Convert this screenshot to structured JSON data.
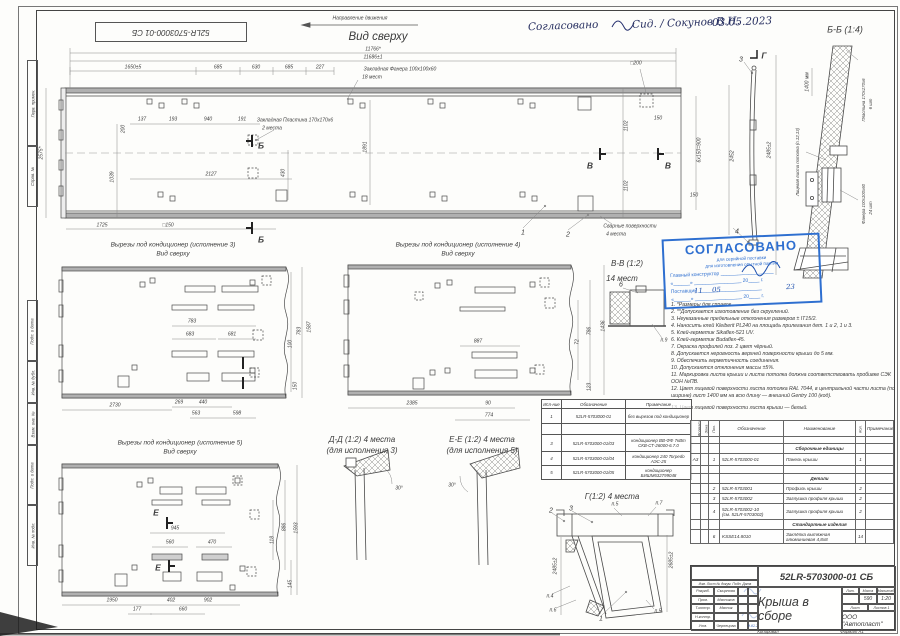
{
  "corner_code": "52LR-5703000-01 СБ",
  "hand": {
    "w": "Согласовано",
    "n": "Сид. / Сокунов В.Н.",
    "d": "03.05.2023"
  },
  "tv": {
    "dir": "Направление движения",
    "title": "Вид сверху",
    "d11766": "11766*",
    "d11686": "11686±1",
    "c1": "1650±5",
    "c2": "685",
    "c3": "630",
    "c4": "685",
    "c5": "227",
    "fanera": "Закладная Фанера 100х100х60",
    "fanera_q": "18 мест",
    "plast": "Закладная Пластина 170х170х6",
    "plast_q": "2 места",
    "sq200": "□200",
    "sq150": "□150",
    "d2575": "2575*",
    "d137": "137",
    "d193": "193",
    "d940": "940",
    "d191": "191",
    "d200": "200",
    "d1039": "1039",
    "d2127": "2127",
    "d430": "430",
    "d1725": "1725",
    "d1891": "1891",
    "d1102": "1102",
    "d150": "150",
    "d6x150": "6х150=900",
    "d2452": "2452",
    "secB": "Б",
    "secV": "В",
    "co1": "1",
    "co2": "2",
    "co3": "3",
    "co4": "4",
    "coG": "Г",
    "weld": "Сварные поверхности",
    "weld_q": "4 места"
  },
  "bb": {
    "title": "Б-Б (1:4)",
    "d1400": "1400 мм",
    "d2485": "2485±2",
    "plate": "Пластина 170х170х6",
    "plate_q": "6 шт",
    "ply": "Фанера 100х100х60",
    "ply_q": "24 шт",
    "face": "Лицевая листа потолка (п.12,13)"
  },
  "c3v": {
    "t": "Вырезы под кондиционер (исполнение 3)",
    "s": "Вид сверху",
    "d783": "783",
    "d683": "683",
    "d681": "681",
    "d2730": "2730",
    "d269": "269",
    "d440": "440",
    "d563": "563",
    "d598": "598",
    "d100": "100",
    "d1587": "1587",
    "d150": "150",
    "d783r": "783"
  },
  "c4v": {
    "t": "Вырезы под кондиционер (исполнение 4)",
    "s": "Вид сверху",
    "d887": "887",
    "d2385": "2385",
    "d90": "90",
    "d774": "774",
    "d72": "72",
    "d786": "786",
    "d1436": "1436",
    "d123": "123"
  },
  "c5v": {
    "t": "Вырезы под кондиционер (исполнение 5)",
    "s": "Вид сверху",
    "secE": "Е",
    "d945": "945",
    "d560": "560",
    "d470": "470",
    "d1950": "1950",
    "d177": "177",
    "d402": "402",
    "d660": "660",
    "d902": "902",
    "d118": "118",
    "d886": "886",
    "d1593": "1593",
    "d145": "145"
  },
  "dd": {
    "t": "Д-Д (1:2) 4 места",
    "s": "(для исполнения 3)",
    "ang": "30°"
  },
  "ee": {
    "t": "Е-Е (1:2) 4 места",
    "s": "(для исполнения 5)",
    "ang": "30°"
  },
  "gg": {
    "t": "Г(1:2) 4 места",
    "co1": "1",
    "co2": "2",
    "co3": "3",
    "n4": "п.4",
    "n5": "п.5",
    "n6": "п.6",
    "n7": "п.7",
    "dl": "2485±2",
    "dr": "2685±2"
  },
  "vv": {
    "t": "В-В (1:2)",
    "s": "14 мест",
    "co6": "6",
    "n9": "п.9"
  },
  "stamp": {
    "t": "СОГЛАСОВАНО",
    "l1": "для серийной поставки",
    "l2": "для изготовления опытной партии",
    "gk": "Главный конструктор ___________________",
    "dt1": "«______» _________________ 20____ г.",
    "post": "Поставщик _______________________",
    "dt2": "«______» _________________ 20____ г.",
    "h1": "11",
    "h2": "05",
    "h3": "23"
  },
  "notes": [
    "1. *Размеры для справок.",
    "2. **Допускается изготовление без скруглений.",
    "3. Неуказанные предельные отклонения размеров ± IT15/2.",
    "4. Наносить клей Kleiberit PL240 на площадь прилегания дет. 1 и 2, 1 и 3.",
    "5. Клей-герметик Sikaflex-521 UV.",
    "6. Клей-герметик Budaflex-45.",
    "7. Окраска профилей поз. 2 цвет чёрный.",
    "8. Допускается неровность верхней поверхности крыши до 5 мм.",
    "9. Обеспечить герметичность соединения.",
    "10. Допускаются отклонения массы ±5%.",
    "11. Маркировка листа крыши и листа потолка должна соответствовать пробивке СЭК ООН №ПВ.",
    "12. Цвет лицевой поверхности листа потолка RAL 7044, в центральной части листа (по ширине) лист 1400 мм на всю длину — внешний Gentry 100 (код).",
    "13. Цвет лицевой поверхности листа крыши — белый."
  ],
  "vt": {
    "h": [
      "Исп-ние",
      "Обозначение",
      "Примечание"
    ],
    "r1": [
      "1",
      "52LR-5703000-01",
      "без вырезов под кондиционер"
    ],
    "r3": [
      "3",
      "52LR-5703000-01/03",
      "кондиционер ВВ-ФФ 7кВт СКВ-СТ-26000-6.7.0"
    ],
    "r4": [
      "4",
      "52LR-5703000-01/04",
      "кондиционер 240 Torpedo АЭС-25"
    ],
    "r5": [
      "5",
      "52LR-5703000-01/05",
      "кондиционер БИШМ632799048"
    ]
  },
  "st": {
    "h": [
      "Формат",
      "Зона",
      "Поз.",
      "Обозначение",
      "Наименование",
      "Кол.",
      "Примечание"
    ],
    "sec1": "Сборочные единицы",
    "sec2": "Детали",
    "sec3": "Стандартные изделия",
    "r1": [
      "А3",
      "",
      "1",
      "52LR-5703000-01",
      "Панель крыши",
      "1"
    ],
    "r2": [
      "",
      "",
      "2",
      "52LR-5703001",
      "Профиль крыши",
      "2"
    ],
    "r3": [
      "",
      "",
      "3",
      "52LR-5703002",
      "Заглушка профиля крыши",
      "2"
    ],
    "r4": [
      "",
      "",
      "4",
      "52LR-5703002-10",
      "Заглушка профиля крыши",
      "2"
    ],
    "r4b": "(см. 52LR-5703002)",
    "r6": [
      "",
      "",
      "6",
      "KSSE14.8010",
      "Заклёпка вытяжная алюминиевая 4,8х8",
      "14"
    ]
  },
  "tb": {
    "code": "52LR-5703000-01 СБ",
    "name": "Крыша в сборе",
    "lit": "Лит.",
    "mass": "Масса",
    "scale": "Масштаб",
    "massv": "590",
    "scalev": "1:20",
    "sheet": "Лист",
    "sheets": "Листов 1",
    "org": "ООО \"Автопласт\"",
    "hdr": "Изм. Лист  № докум.  Подп.  Дата",
    "r1l": "Разраб.",
    "r1v": "Смирнова",
    "r2l": "Пров.",
    "r2v": "Мясников",
    "r3l": "Т.контр.",
    "r3v": "Мясник",
    "r4l": "Н.контр.",
    "r4v": "",
    "r5l": "Утв.",
    "r5v": "Чернецова",
    "hd": "09.02.23"
  },
  "side": [
    "Перв. примен.",
    "Справ. №",
    "Подп. и дата",
    "Инв. № дубл.",
    "Взам. инв. №",
    "Подп. и дата",
    "Инв. № подл."
  ],
  "foot": {
    "k": "Копировал",
    "f": "Формат А1"
  }
}
